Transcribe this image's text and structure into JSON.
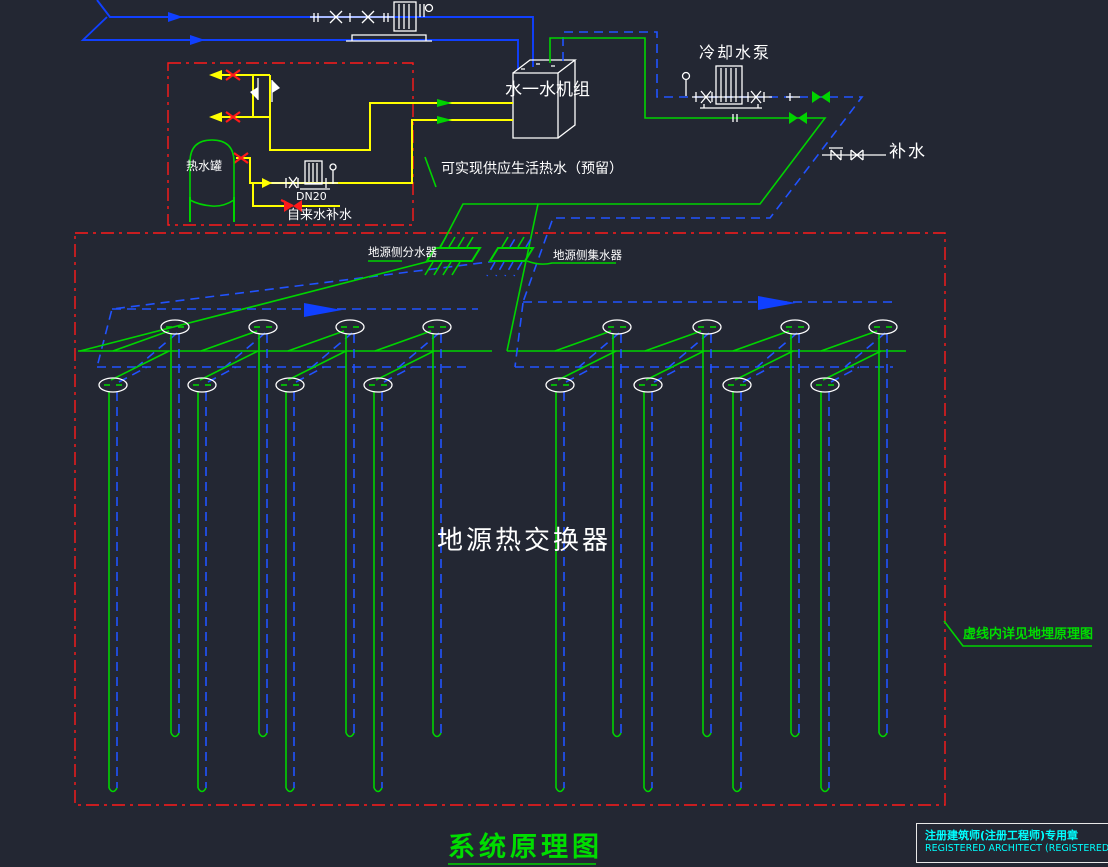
{
  "drawing": {
    "title": "系统原理图",
    "note_dashed_area": "虚线内详见地埋原理图",
    "ground_heat_exchanger": "地源热交换器"
  },
  "equipment_labels": {
    "water_water_unit": "水一水机组",
    "cooling_pump": "冷却水泵",
    "makeup_water": "补水",
    "hot_water_tank": "热水罐",
    "pipe_size": "DN20",
    "tap_water_makeup": "自来水补水",
    "dhw_note": "可实现供应生活热水（预留）",
    "source_side_distributor": "地源侧分水器",
    "source_side_collector": "地源侧集水器"
  },
  "stamp_block": {
    "line1": "注册建筑师(注册工程师)专用章",
    "line2": "REGISTERED ARCHITECT (REGISTERED ENGINEER) STAMP"
  },
  "colors": {
    "background": "#232733",
    "pipe_blue": "#1040ff",
    "pipe_blue_dashed": "#2153ff",
    "pipe_green": "#00d400",
    "pipe_yellow": "#ffff00",
    "boundary_red": "#ff1a1a",
    "symbol_white": "#ffffff",
    "stamp_cyan": "#00ffff",
    "title_green": "#00dd00"
  },
  "symbols": {
    "gate_valve_icon": "bowtie",
    "shutoff_valve_icon": "red-cross",
    "check_valve_icon": "flag",
    "pump_icon": "motor-on-base",
    "strainer_icon": "n-glyph",
    "flow_arrow_icon": "triangle",
    "borehole_icon": "ellipse-with-u-tube",
    "manifold_icon": "parallelogram"
  }
}
